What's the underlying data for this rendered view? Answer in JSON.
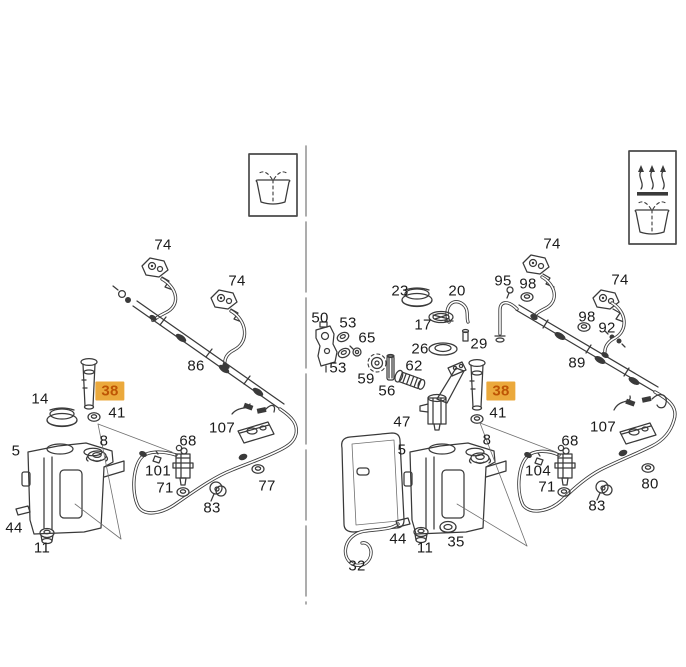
{
  "canvas": {
    "width": 686,
    "height": 667,
    "background": "#ffffff"
  },
  "divider": {
    "orientation": "vertical"
  },
  "highlight": {
    "background": "#EBA93C",
    "text_color": "#BE5504"
  },
  "insets": {
    "left_box": {
      "icons": [
        "windshield-washer-spray-icon"
      ]
    },
    "right_box": {
      "icons": [
        "heated-washer-jets-icon",
        "windshield-washer-spray-icon"
      ]
    }
  },
  "labels": [
    {
      "text": "74",
      "x": 163,
      "y": 245,
      "panel": "left",
      "highlighted": false
    },
    {
      "text": "74",
      "x": 237,
      "y": 281,
      "panel": "left",
      "highlighted": false
    },
    {
      "text": "86",
      "x": 196,
      "y": 366,
      "panel": "left",
      "highlighted": false
    },
    {
      "text": "14",
      "x": 40,
      "y": 399,
      "panel": "left",
      "highlighted": false
    },
    {
      "text": "38",
      "x": 110,
      "y": 391,
      "panel": "left",
      "highlighted": true
    },
    {
      "text": "41",
      "x": 117,
      "y": 413,
      "panel": "left",
      "highlighted": false
    },
    {
      "text": "8",
      "x": 104,
      "y": 441,
      "panel": "left",
      "highlighted": false
    },
    {
      "text": "5",
      "x": 16,
      "y": 451,
      "panel": "left",
      "highlighted": false
    },
    {
      "text": "107",
      "x": 222,
      "y": 428,
      "panel": "left",
      "highlighted": false
    },
    {
      "text": "68",
      "x": 188,
      "y": 441,
      "panel": "left",
      "highlighted": false
    },
    {
      "text": "101",
      "x": 158,
      "y": 471,
      "panel": "left",
      "highlighted": false
    },
    {
      "text": "71",
      "x": 165,
      "y": 488,
      "panel": "left",
      "highlighted": false
    },
    {
      "text": "77",
      "x": 267,
      "y": 486,
      "panel": "left",
      "highlighted": false
    },
    {
      "text": "83",
      "x": 212,
      "y": 508,
      "panel": "left",
      "highlighted": false
    },
    {
      "text": "44",
      "x": 14,
      "y": 528,
      "panel": "left",
      "highlighted": false
    },
    {
      "text": "11",
      "x": 42,
      "y": 548,
      "panel": "left",
      "highlighted": false
    },
    {
      "text": "74",
      "x": 552,
      "y": 244,
      "panel": "right",
      "highlighted": false
    },
    {
      "text": "74",
      "x": 620,
      "y": 280,
      "panel": "right",
      "highlighted": false
    },
    {
      "text": "95",
      "x": 503,
      "y": 281,
      "panel": "right",
      "highlighted": false
    },
    {
      "text": "98",
      "x": 528,
      "y": 284,
      "panel": "right",
      "highlighted": false
    },
    {
      "text": "98",
      "x": 587,
      "y": 317,
      "panel": "right",
      "highlighted": false
    },
    {
      "text": "92",
      "x": 607,
      "y": 328,
      "panel": "right",
      "highlighted": false
    },
    {
      "text": "23",
      "x": 400,
      "y": 291,
      "panel": "right",
      "highlighted": false
    },
    {
      "text": "20",
      "x": 457,
      "y": 291,
      "panel": "right",
      "highlighted": false
    },
    {
      "text": "17",
      "x": 423,
      "y": 325,
      "panel": "right",
      "highlighted": false
    },
    {
      "text": "26",
      "x": 420,
      "y": 349,
      "panel": "right",
      "highlighted": false
    },
    {
      "text": "29",
      "x": 479,
      "y": 344,
      "panel": "right",
      "highlighted": false
    },
    {
      "text": "50",
      "x": 320,
      "y": 318,
      "panel": "right",
      "highlighted": false
    },
    {
      "text": "53",
      "x": 348,
      "y": 323,
      "panel": "right",
      "highlighted": false
    },
    {
      "text": "65",
      "x": 367,
      "y": 338,
      "panel": "right",
      "highlighted": false
    },
    {
      "text": "53",
      "x": 338,
      "y": 368,
      "panel": "right",
      "highlighted": false
    },
    {
      "text": "59",
      "x": 366,
      "y": 379,
      "panel": "right",
      "highlighted": false
    },
    {
      "text": "62",
      "x": 414,
      "y": 366,
      "panel": "right",
      "highlighted": false
    },
    {
      "text": "56",
      "x": 387,
      "y": 391,
      "panel": "right",
      "highlighted": false
    },
    {
      "text": "89",
      "x": 577,
      "y": 363,
      "panel": "right",
      "highlighted": false
    },
    {
      "text": "47",
      "x": 402,
      "y": 422,
      "panel": "right",
      "highlighted": false
    },
    {
      "text": "38",
      "x": 501,
      "y": 391,
      "panel": "right",
      "highlighted": true
    },
    {
      "text": "41",
      "x": 498,
      "y": 413,
      "panel": "right",
      "highlighted": false
    },
    {
      "text": "8",
      "x": 487,
      "y": 440,
      "panel": "right",
      "highlighted": false
    },
    {
      "text": "5",
      "x": 402,
      "y": 450,
      "panel": "right",
      "highlighted": false
    },
    {
      "text": "107",
      "x": 603,
      "y": 427,
      "panel": "right",
      "highlighted": false
    },
    {
      "text": "68",
      "x": 570,
      "y": 441,
      "panel": "right",
      "highlighted": false
    },
    {
      "text": "104",
      "x": 538,
      "y": 471,
      "panel": "right",
      "highlighted": false
    },
    {
      "text": "71",
      "x": 547,
      "y": 487,
      "panel": "right",
      "highlighted": false
    },
    {
      "text": "80",
      "x": 650,
      "y": 484,
      "panel": "right",
      "highlighted": false
    },
    {
      "text": "83",
      "x": 597,
      "y": 506,
      "panel": "right",
      "highlighted": false
    },
    {
      "text": "44",
      "x": 398,
      "y": 539,
      "panel": "right",
      "highlighted": false
    },
    {
      "text": "11",
      "x": 425,
      "y": 548,
      "panel": "right",
      "highlighted": false
    },
    {
      "text": "35",
      "x": 456,
      "y": 542,
      "panel": "right",
      "highlighted": false
    },
    {
      "text": "32",
      "x": 357,
      "y": 566,
      "panel": "right",
      "highlighted": false
    }
  ]
}
